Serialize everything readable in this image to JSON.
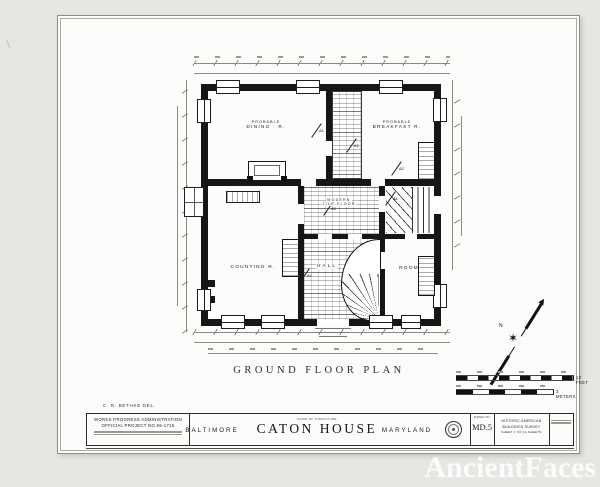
{
  "photo": {
    "watermark": "AncientFaces"
  },
  "drawing": {
    "plan_title": "GROUND FLOOR PLAN",
    "delineator": "C. R. BETHKE DEL.",
    "north_label": "N",
    "rooms": {
      "dining_line1": "PROBABLE",
      "dining_line2": "DINING · R.",
      "breakfast_line1": "PROBABLE",
      "breakfast_line2": "BREAKFAST R.",
      "counting": "COUNTING R.",
      "hall": "HALL",
      "room": "ROOM",
      "passage_line1": "MODERN",
      "passage_line2": "TILE FLOOR"
    },
    "section_markers": {
      "a1": "A1",
      "a2": "A2"
    },
    "scalebars": {
      "feet": "10 FEET",
      "meters": "3 METERS"
    }
  },
  "titleblock": {
    "wpa_line1": "WORKS PROGRESS ADMINISTRATION",
    "wpa_line2": "OFFICIAL PROJECT NO.65-1715",
    "city": "BALTIMORE",
    "name_header": "NAME OF STRUCTURE",
    "structure_name": "CATON HOUSE",
    "state": "MARYLAND",
    "survey_header": "SURVEY NO.",
    "survey_no": "MD.5",
    "habs_line1": "HISTORIC AMERICAN",
    "habs_line2": "BUILDINGS SURVEY",
    "habs_line3": "SHEET 1 OF 14 SHEETS"
  }
}
